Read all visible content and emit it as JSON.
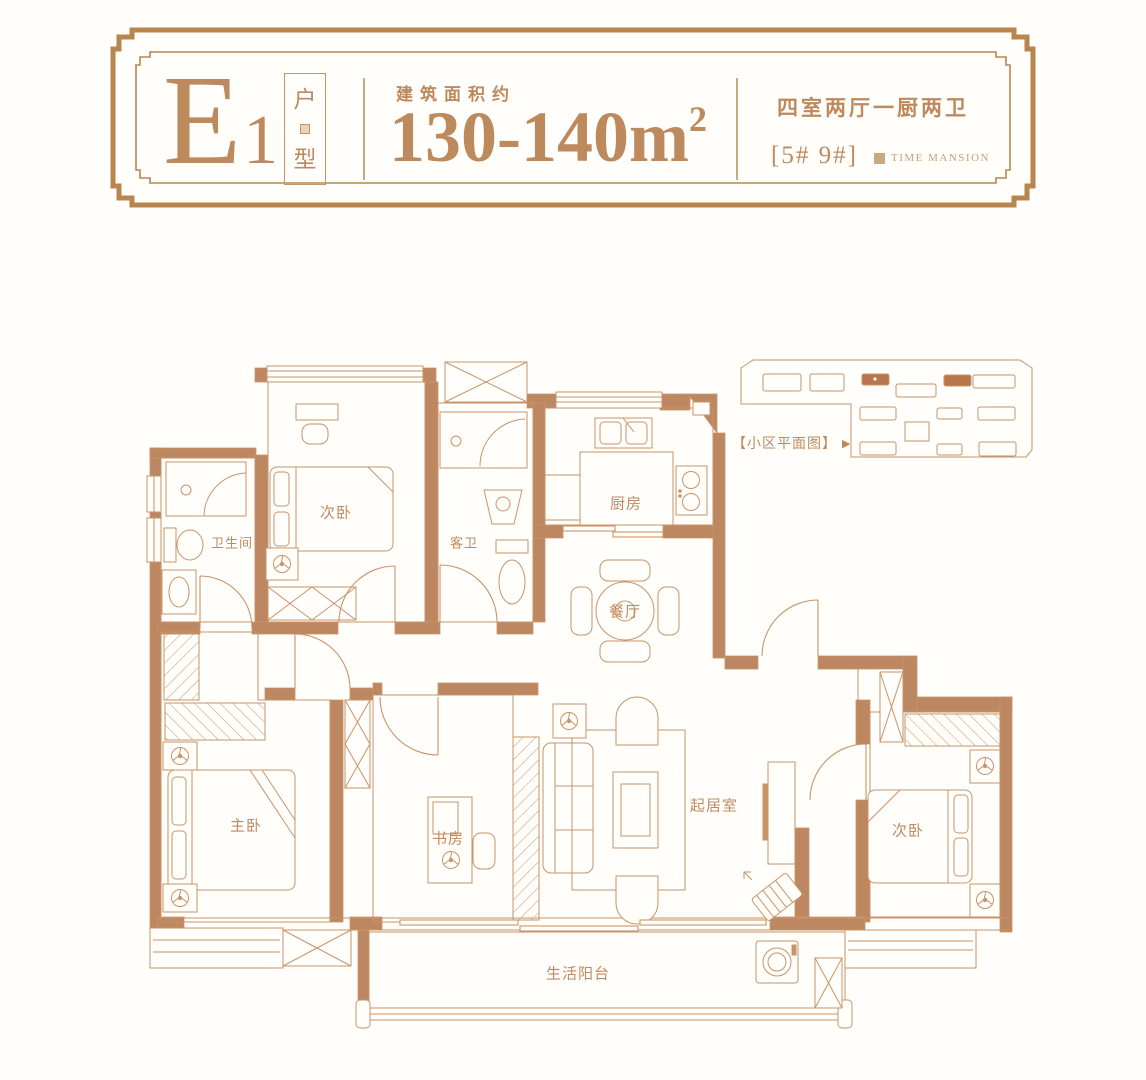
{
  "header": {
    "unit_code_main": "E",
    "unit_code_sub": "1",
    "unit_type_chars": [
      "户",
      "型"
    ],
    "area_label": "建筑面积约",
    "area_value": "130-140m",
    "area_unit_sup": "2",
    "rooms_desc": "四室两厅一厨两卫",
    "building_nos": "[5# 9#]",
    "brand_name": "TIME MANSION"
  },
  "site_plan": {
    "label": "【小区平面图】",
    "arrow_icon": "▶"
  },
  "rooms": [
    {
      "id": "bath-main",
      "label": "卫生间"
    },
    {
      "id": "bedroom-2",
      "label": "次卧"
    },
    {
      "id": "bath-guest",
      "label": "客卫"
    },
    {
      "id": "kitchen",
      "label": "厨房"
    },
    {
      "id": "dining",
      "label": "餐厅"
    },
    {
      "id": "master",
      "label": "主卧"
    },
    {
      "id": "study",
      "label": "书房"
    },
    {
      "id": "living",
      "label": "起居室"
    },
    {
      "id": "bedroom-3",
      "label": "次卧"
    },
    {
      "id": "balcony",
      "label": "生活阳台"
    }
  ],
  "colors": {
    "accent_text": "#bd8a5e",
    "frame": "#b9854f",
    "plan_line": "#c9946a",
    "wall_fill": "#bd8762",
    "highlight_building": "#b8764a",
    "background": "#fffefb"
  }
}
